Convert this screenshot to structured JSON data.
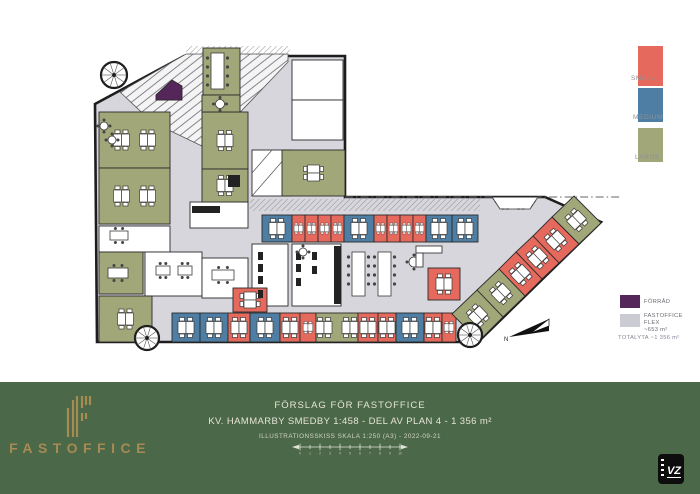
{
  "colors": {
    "small": "#E56A5D",
    "medium": "#4E7EA3",
    "large": "#A2A779",
    "forrad": "#55265A",
    "flex": "#D6D6DC",
    "swatch_flex": "#CBCBD4",
    "wall": "#1D1D1D",
    "footer_bg": "#4B6848",
    "logo_gold": "#A68B53"
  },
  "legend_sizes": [
    {
      "label": "SMALL",
      "color_key": "small"
    },
    {
      "label": "MEDIUM",
      "color_key": "medium"
    },
    {
      "label": "LARGE",
      "color_key": "large"
    }
  ],
  "legend_areas": [
    {
      "label": "FÖRRÅD",
      "color_key": "forrad"
    },
    {
      "label": "FASTOFFICE FLEX",
      "sublabel": "~653 m²",
      "color_key": "swatch_flex"
    }
  ],
  "total_label": "TOTALYTA ~1 356 m²",
  "north_label": "N",
  "viz_logo": "VZ",
  "footer": {
    "line1": "FÖRSLAG FÖR FASTOFFICE",
    "line2": "KV. HAMMARBY SMEDBY 1:458 - DEL AV PLAN 4 - 1 356 m²",
    "line3": "ILLUSTRATIONSSKISS SKALA 1:250 (A3) - 2022-09-21",
    "brand": "FASTOFFICE",
    "scalebar_ticks": [
      "0",
      "1",
      "2",
      "3",
      "4",
      "5",
      "6",
      "7",
      "8",
      "9",
      "10"
    ]
  },
  "floorplan": {
    "footprint": "95,104 184,56 345,56 345,197 545,197 601,222 478,342 97,342",
    "atrium": [
      [
        120,
        92
      ],
      [
        186,
        54
      ],
      [
        288,
        54
      ],
      [
        288,
        62
      ],
      [
        206,
        148
      ],
      [
        152,
        122
      ]
    ],
    "facade_strips": [
      [
        250,
        199,
        230,
        12
      ],
      [
        186,
        46,
        104,
        9
      ]
    ],
    "boundary": "345,197 492,197 500,209 530,209 538,197 622,197",
    "rooms": [
      {
        "sh": "r",
        "x": 292,
        "y": 60,
        "w": 51,
        "h": 40,
        "f": "white",
        "d": 0
      },
      {
        "sh": "r",
        "x": 292,
        "y": 100,
        "w": 51,
        "h": 40,
        "f": "white",
        "d": 0
      },
      {
        "sh": "r",
        "x": 252,
        "y": 150,
        "w": 40,
        "h": 46,
        "f": "white",
        "d": 0,
        "st": 1
      },
      {
        "sh": "r",
        "x": 190,
        "y": 202,
        "w": 58,
        "h": 26,
        "f": "white",
        "d": 0
      },
      {
        "sh": "r",
        "x": 252,
        "y": 244,
        "w": 36,
        "h": 62,
        "f": "white",
        "d": 0
      },
      {
        "sh": "r",
        "x": 292,
        "y": 244,
        "w": 49,
        "h": 62,
        "f": "white",
        "d": 0
      },
      {
        "sh": "r",
        "x": 99,
        "y": 226,
        "w": 71,
        "h": 26,
        "f": "white",
        "d": 0
      },
      {
        "sh": "r",
        "x": 145,
        "y": 252,
        "w": 57,
        "h": 44,
        "f": "white",
        "d": 0
      },
      {
        "sh": "r",
        "x": 202,
        "y": 258,
        "w": 46,
        "h": 40,
        "f": "white",
        "d": 0
      },
      {
        "sh": "p",
        "pts": [
          [
            492,
            197
          ],
          [
            538,
            197
          ],
          [
            530,
            209
          ],
          [
            500,
            209
          ]
        ],
        "f": "white",
        "d": 0
      },
      {
        "sh": "r",
        "x": 99,
        "y": 112,
        "w": 71,
        "h": 56,
        "f": "large",
        "d": 2
      },
      {
        "sh": "r",
        "x": 99,
        "y": 168,
        "w": 71,
        "h": 56,
        "f": "large",
        "d": 2
      },
      {
        "sh": "r",
        "x": 99,
        "y": 296,
        "w": 53,
        "h": 46,
        "f": "large",
        "d": 1
      },
      {
        "sh": "r",
        "x": 202,
        "y": 112,
        "w": 46,
        "h": 57,
        "f": "large",
        "d": 1
      },
      {
        "sh": "r",
        "x": 202,
        "y": 169,
        "w": 46,
        "h": 33,
        "f": "large",
        "d": 1
      },
      {
        "sh": "r",
        "x": 99,
        "y": 252,
        "w": 44,
        "h": 42,
        "f": "large",
        "d": 0
      },
      {
        "sh": "r",
        "x": 203,
        "y": 48,
        "w": 37,
        "h": 47,
        "f": "large",
        "d": 0
      },
      {
        "sh": "r",
        "x": 202,
        "y": 95,
        "w": 38,
        "h": 17,
        "f": "large",
        "d": 0
      },
      {
        "sh": "r",
        "x": 282,
        "y": 150,
        "w": 63,
        "h": 46,
        "f": "large",
        "d": 1,
        "rot": 90
      },
      {
        "sh": "r",
        "x": 262,
        "y": 215,
        "w": 30,
        "h": 27,
        "f": "medium",
        "d": 1
      },
      {
        "sh": "r",
        "x": 292,
        "y": 215,
        "w": 13,
        "h": 27,
        "f": "small",
        "d": 1,
        "s": 0.55
      },
      {
        "sh": "r",
        "x": 305,
        "y": 215,
        "w": 13,
        "h": 27,
        "f": "small",
        "d": 1,
        "s": 0.55
      },
      {
        "sh": "r",
        "x": 318,
        "y": 215,
        "w": 13,
        "h": 27,
        "f": "small",
        "d": 1,
        "s": 0.55
      },
      {
        "sh": "r",
        "x": 331,
        "y": 215,
        "w": 13,
        "h": 27,
        "f": "small",
        "d": 1,
        "s": 0.55
      },
      {
        "sh": "r",
        "x": 344,
        "y": 215,
        "w": 30,
        "h": 27,
        "f": "medium",
        "d": 1
      },
      {
        "sh": "r",
        "x": 374,
        "y": 215,
        "w": 13,
        "h": 27,
        "f": "small",
        "d": 1,
        "s": 0.55
      },
      {
        "sh": "r",
        "x": 387,
        "y": 215,
        "w": 13,
        "h": 27,
        "f": "small",
        "d": 1,
        "s": 0.55
      },
      {
        "sh": "r",
        "x": 400,
        "y": 215,
        "w": 13,
        "h": 27,
        "f": "small",
        "d": 1,
        "s": 0.55
      },
      {
        "sh": "r",
        "x": 413,
        "y": 215,
        "w": 13,
        "h": 27,
        "f": "small",
        "d": 1,
        "s": 0.55
      },
      {
        "sh": "r",
        "x": 426,
        "y": 215,
        "w": 26,
        "h": 27,
        "f": "medium",
        "d": 1
      },
      {
        "sh": "r",
        "x": 452,
        "y": 215,
        "w": 26,
        "h": 27,
        "f": "medium",
        "d": 1
      },
      {
        "sh": "r",
        "x": 172,
        "y": 313,
        "w": 28,
        "h": 29,
        "f": "medium",
        "d": 1
      },
      {
        "sh": "r",
        "x": 200,
        "y": 313,
        "w": 28,
        "h": 29,
        "f": "medium",
        "d": 1
      },
      {
        "sh": "r",
        "x": 228,
        "y": 313,
        "w": 22,
        "h": 29,
        "f": "small",
        "d": 1
      },
      {
        "sh": "r",
        "x": 250,
        "y": 313,
        "w": 30,
        "h": 29,
        "f": "medium",
        "d": 1
      },
      {
        "sh": "r",
        "x": 280,
        "y": 313,
        "w": 20,
        "h": 29,
        "f": "small",
        "d": 1
      },
      {
        "sh": "r",
        "x": 300,
        "y": 313,
        "w": 16,
        "h": 29,
        "f": "small",
        "d": 1,
        "s": 0.6
      },
      {
        "sh": "r",
        "x": 316,
        "y": 313,
        "w": 42,
        "h": 29,
        "f": "large",
        "d": 2
      },
      {
        "sh": "r",
        "x": 358,
        "y": 313,
        "w": 20,
        "h": 29,
        "f": "small",
        "d": 1
      },
      {
        "sh": "r",
        "x": 378,
        "y": 313,
        "w": 18,
        "h": 29,
        "f": "small",
        "d": 1
      },
      {
        "sh": "r",
        "x": 396,
        "y": 313,
        "w": 28,
        "h": 29,
        "f": "medium",
        "d": 1
      },
      {
        "sh": "r",
        "x": 424,
        "y": 313,
        "w": 18,
        "h": 29,
        "f": "small",
        "d": 1
      },
      {
        "sh": "r",
        "x": 442,
        "y": 313,
        "w": 14,
        "h": 29,
        "f": "small",
        "d": 1,
        "s": 0.6
      },
      {
        "sh": "r",
        "x": 428,
        "y": 268,
        "w": 32,
        "h": 32,
        "f": "small",
        "d": 1
      },
      {
        "sh": "r",
        "x": 233,
        "y": 288,
        "w": 34,
        "h": 24,
        "f": "small",
        "d": 1,
        "rot": 90
      },
      {
        "sh": "p",
        "pts": [
          [
            574,
            196
          ],
          [
            601,
            223
          ],
          [
            579,
            244
          ],
          [
            552,
            217
          ]
        ],
        "f": "large",
        "d": 1,
        "rot": -44
      },
      {
        "sh": "p",
        "pts": [
          [
            552,
            217
          ],
          [
            579,
            244
          ],
          [
            559,
            263
          ],
          [
            533,
            236
          ]
        ],
        "f": "small",
        "d": 1,
        "rot": -44
      },
      {
        "sh": "p",
        "pts": [
          [
            533,
            236
          ],
          [
            559,
            263
          ],
          [
            542,
            279
          ],
          [
            516,
            252
          ]
        ],
        "f": "small",
        "d": 1,
        "rot": -44
      },
      {
        "sh": "p",
        "pts": [
          [
            516,
            252
          ],
          [
            542,
            279
          ],
          [
            525,
            296
          ],
          [
            499,
            269
          ]
        ],
        "f": "small",
        "d": 1,
        "rot": -44
      },
      {
        "sh": "p",
        "pts": [
          [
            499,
            269
          ],
          [
            525,
            296
          ],
          [
            503,
            317
          ],
          [
            477,
            290
          ]
        ],
        "f": "large",
        "d": 1,
        "rot": -44
      },
      {
        "sh": "p",
        "pts": [
          [
            477,
            290
          ],
          [
            503,
            317
          ],
          [
            479,
            341
          ],
          [
            452,
            314
          ]
        ],
        "f": "large",
        "d": 1,
        "rot": -44
      },
      {
        "sh": "p",
        "pts": [
          [
            156,
            95
          ],
          [
            172,
            80
          ],
          [
            182,
            86
          ],
          [
            182,
            100
          ],
          [
            156,
            100
          ]
        ],
        "f": "forrad",
        "d": 0
      }
    ],
    "fixtures": [
      [
        192,
        206,
        28,
        7
      ],
      [
        334,
        246,
        7,
        58
      ],
      [
        228,
        175,
        12,
        12
      ],
      [
        258,
        252,
        5,
        8
      ],
      [
        258,
        264,
        5,
        8
      ],
      [
        258,
        276,
        5,
        8
      ],
      [
        258,
        290,
        5,
        8
      ],
      [
        296,
        252,
        5,
        8
      ],
      [
        296,
        264,
        5,
        8
      ],
      [
        296,
        278,
        5,
        8
      ],
      [
        312,
        252,
        5,
        8
      ],
      [
        312,
        266,
        5,
        8
      ]
    ],
    "tables_long": [
      [
        352,
        252,
        44
      ],
      [
        378,
        252,
        44
      ],
      [
        211,
        53,
        36
      ]
    ],
    "tables_rect": [
      [
        110,
        231,
        18,
        9
      ],
      [
        156,
        266,
        14,
        9
      ],
      [
        178,
        266,
        14,
        9
      ],
      [
        212,
        270,
        22,
        10
      ],
      [
        108,
        268,
        20,
        10
      ]
    ],
    "tables_round": [
      [
        104,
        126,
        4
      ],
      [
        112,
        140,
        4
      ],
      [
        220,
        104,
        4.5
      ],
      [
        414,
        262,
        5
      ],
      [
        303,
        252,
        4
      ]
    ],
    "sofa": [
      [
        416,
        246,
        26,
        7
      ],
      [
        416,
        253,
        7,
        14
      ]
    ],
    "stairs": [
      [
        114,
        75,
        13
      ],
      [
        147,
        338,
        12
      ],
      [
        470,
        335,
        12
      ]
    ],
    "north": {
      "tri1": [
        [
          549,
          319
        ],
        [
          509,
          337
        ],
        [
          549,
          331
        ]
      ],
      "tri2": [
        [
          549,
          319
        ],
        [
          531,
          333
        ],
        [
          549,
          326
        ]
      ],
      "lx": 504,
      "ly": 341
    }
  }
}
